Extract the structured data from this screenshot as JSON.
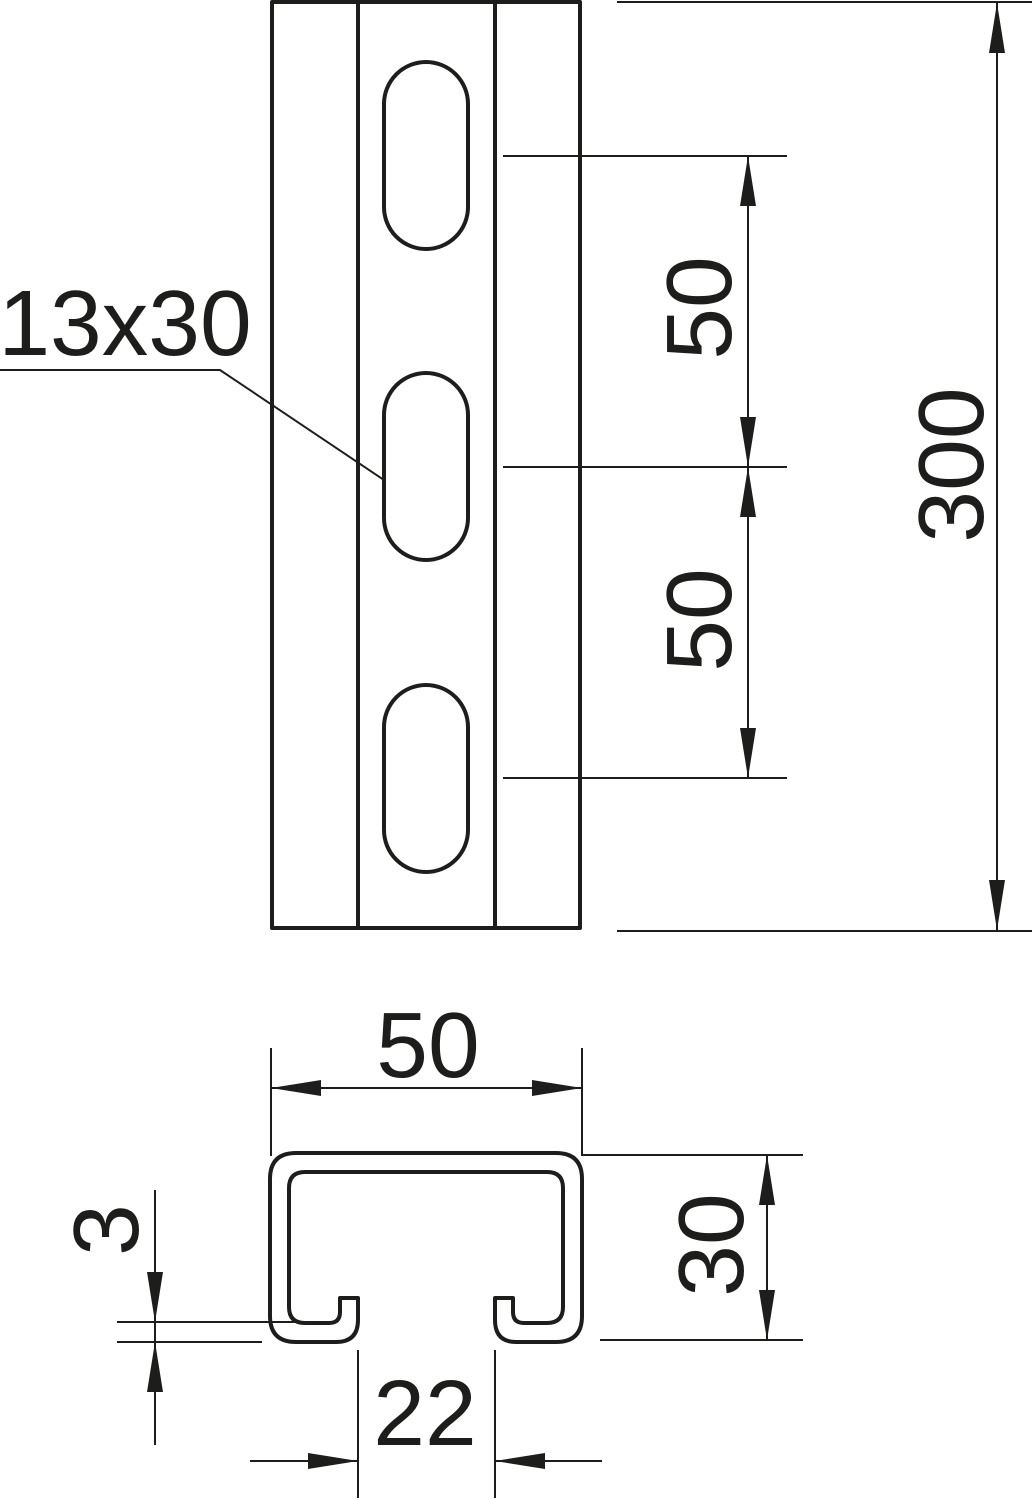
{
  "drawing": {
    "title": "Profile rail technical drawing",
    "colors": {
      "line": "#1d1d1b",
      "background": "#ffffff"
    },
    "front_view": {
      "slot_size_label": "13x30",
      "slot_count": 3,
      "dim_slot_spacing_top": "50",
      "dim_slot_spacing_bottom": "50",
      "dim_total_length": "300"
    },
    "cross_section": {
      "dim_profile_width": "50",
      "dim_profile_height": "30",
      "dim_wall_thickness": "3",
      "dim_slot_opening": "22"
    }
  }
}
